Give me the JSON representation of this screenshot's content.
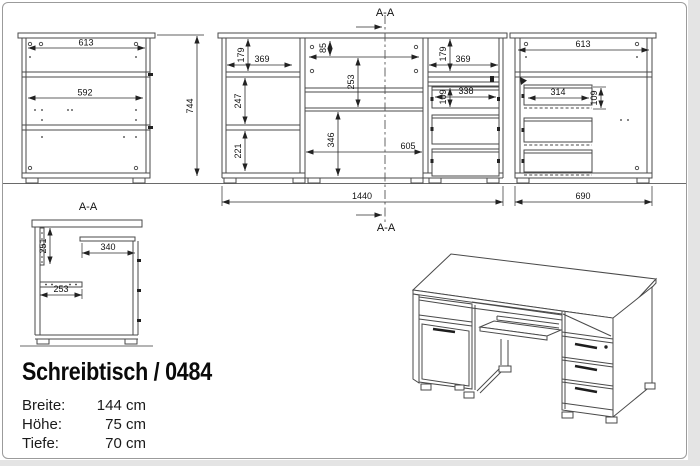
{
  "title_block": {
    "title": "Schreibtisch / 0484",
    "specs": [
      {
        "label": "Breite:",
        "value": "144 cm"
      },
      {
        "label": "Höhe:",
        "value": "75 cm"
      },
      {
        "label": "Tiefe:",
        "value": "70 cm"
      }
    ]
  },
  "section_marker": "A-A",
  "dims": {
    "rear_top_width": "613",
    "rear_inner_width": "592",
    "total_height": "744",
    "front_left_open_height": "179",
    "front_left_width": "369",
    "front_left_mid_height": "247",
    "front_left_bottom_height": "221",
    "front_mid_rail_height": "85",
    "front_mid_tray_height": "253",
    "front_mid_knee_height": "346",
    "front_mid_width": "605",
    "front_right_open_height": "179",
    "front_right_width": "369",
    "front_right_drawer_height": "109",
    "front_right_drawer_width": "338",
    "front_total_width": "1440",
    "side_top_width": "613",
    "side_drawer_depth": "314",
    "side_drawer_height": "109",
    "side_total_depth": "690",
    "section_panel_height": "251",
    "section_shelf_depth": "340",
    "section_rail_depth": "253"
  },
  "colors": {
    "line": "#4a4a4a",
    "dim_text": "#111111",
    "border": "#9b9b9b"
  }
}
